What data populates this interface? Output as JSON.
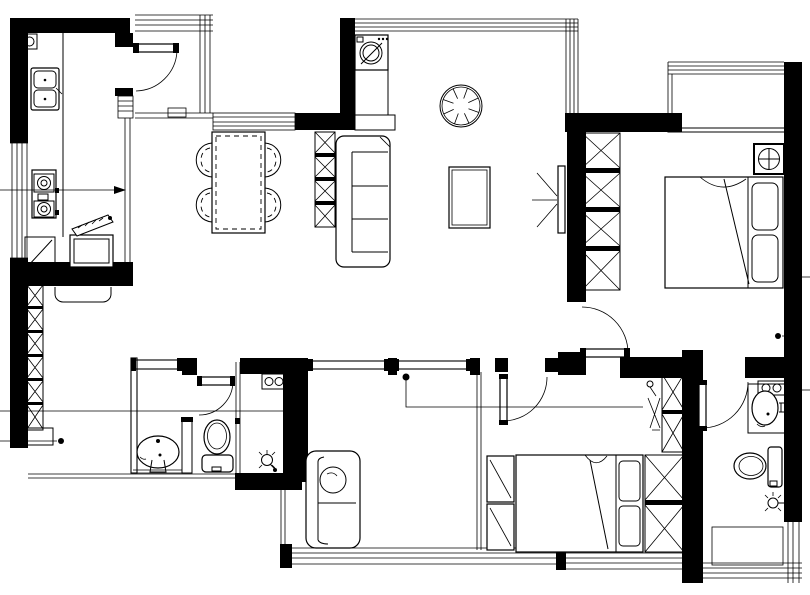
{
  "document": {
    "type": "architectural floor plan",
    "style": "black-and-white CAD line drawing, plan view, no text labels",
    "canvas": {
      "width": 810,
      "height": 595
    }
  },
  "colors": {
    "ink": "#000000",
    "paper": "#ffffff",
    "wall_fill": "#000000"
  },
  "rooms": [
    {
      "id": "entry",
      "label": "Entry porch with step lines and door mat"
    },
    {
      "id": "kitchen",
      "label": "Kitchen",
      "fixtures": [
        "meter-box",
        "double-bowl-sink",
        "two-burner-cooktop",
        "corner-cabinet",
        "appliance-with-open-hatched-lid",
        "counter"
      ]
    },
    {
      "id": "living-dining",
      "label": "Living / dining room",
      "fixtures": [
        "washing-machine",
        "ceiling-fan",
        "dining-table",
        "dining-chair x4",
        "x-shelf-unit",
        "three-seat-sofa",
        "coffee-table",
        "wall-tv"
      ]
    },
    {
      "id": "hallway",
      "label": "Hallway",
      "fixtures": [
        "tall-x-cabinet"
      ]
    },
    {
      "id": "master-bedroom",
      "label": "Master bedroom",
      "fixtures": [
        "x-wardrobe-4-cell",
        "double-bed-with-2-pillows",
        "ac-fan-unit",
        "switch-dot"
      ]
    },
    {
      "id": "bay-window",
      "label": "Bay window / balcony strip"
    },
    {
      "id": "ensuite-bathroom",
      "label": "Ensuite bathroom",
      "fixtures": [
        "utility-box-two-circles",
        "washbasin-with-tap",
        "toilet",
        "shower-head"
      ]
    },
    {
      "id": "laundry-room",
      "label": "Shower / laundry room with window band"
    },
    {
      "id": "bedroom-2",
      "label": "Bedroom 2",
      "fixtures": [
        "loveseat-sofa-with-round-pillow"
      ],
      "windows": [
        "bottom-window-band",
        "two-top-window-strips"
      ]
    },
    {
      "id": "bedroom-3",
      "label": "Bedroom 3",
      "fixtures": [
        "nightstand x2",
        "double-bed-with-2-pillows",
        "x-wardrobe-2-cell",
        "x-closet-2-cell",
        "drying-rack"
      ]
    },
    {
      "id": "shared-bathroom",
      "label": "Shared bathroom",
      "fixtures": [
        "pedestal-washbasin",
        "toilet",
        "glass-partition",
        "shower-head",
        "utility-box-two-circles"
      ]
    }
  ],
  "doors": [
    {
      "id": "kitchen-entry-door",
      "state": "open with quarter-circle swing"
    },
    {
      "id": "bathroom-1-door",
      "state": "open with quarter-circle swing"
    },
    {
      "id": "master-bedroom-door",
      "state": "open with quarter-circle swing"
    },
    {
      "id": "bedroom-3-door",
      "state": "open with quarter-circle swing"
    },
    {
      "id": "ensuite-bathroom-door",
      "state": "open with quarter-circle swing"
    }
  ],
  "annotations": {
    "leader_line_left_upper": "horizontal line at y=190 from left edge ending in solid arrow",
    "leader_line_left_lower": "horizontal line at y=411 across hallway and bathroom",
    "leader_polyline_center": "dot at (406,377) dropping to y=407 then running right to wardrobe",
    "leader_line_bottom_left": "short line at y=441 ending in dot",
    "reference_dots": 4,
    "right_edge_ticks": 3
  }
}
